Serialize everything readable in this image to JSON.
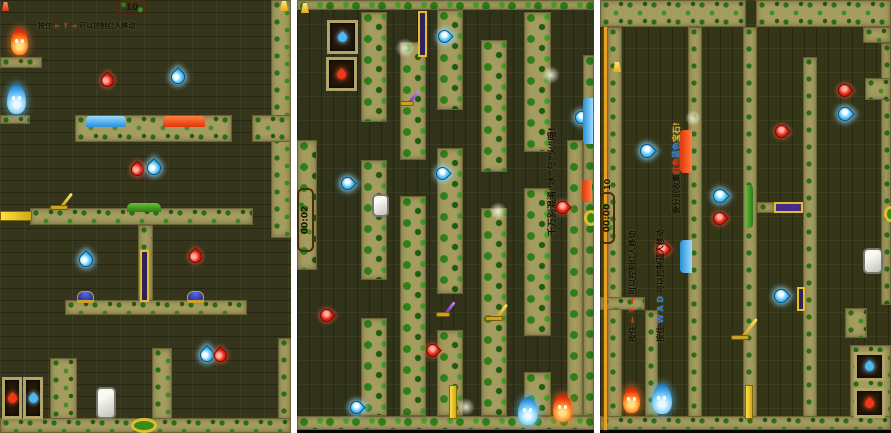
{
  "app": {
    "description": "Three level screenshots of a forest ice-and-fire two-player maze game",
    "background_color": "#ffffff"
  },
  "colors": {
    "wall_khaki": "#a59c60",
    "maze_dark": "#35351c",
    "leaf_green": "#2e8018",
    "gem_red": "#e82818",
    "gem_blue": "#58c8ff",
    "fireboy_red": "#e03010",
    "watergirl_blue": "#2888d0",
    "lever_gold": "#e0be2e",
    "lever_purple": "#6a2ab8",
    "sign_wood": "#8a5c2a",
    "text_dark": "#141005",
    "text_red": "#d83214",
    "text_blue": "#2f7fe0",
    "text_gold": "#e2b81c"
  },
  "panels": [
    {
      "id": "level-a-landscape",
      "mossy": false,
      "hud": {
        "sign": "10"
      },
      "walls": [
        [
          271,
          0,
          20,
          238
        ],
        [
          252,
          115,
          39,
          27
        ],
        [
          0,
          57,
          42,
          11
        ],
        [
          0,
          115,
          30,
          9
        ],
        [
          75,
          115,
          157,
          27
        ],
        [
          30,
          208,
          223,
          17
        ],
        [
          138,
          225,
          15,
          77
        ],
        [
          65,
          300,
          182,
          15
        ],
        [
          152,
          348,
          20,
          72
        ],
        [
          50,
          358,
          27,
          62
        ],
        [
          278,
          338,
          13,
          82
        ],
        [
          0,
          418,
          291,
          15
        ]
      ],
      "objects": [
        {
          "type": "lantern",
          "color": "red",
          "x": 2,
          "y": 2,
          "w": 7,
          "h": 9
        },
        {
          "type": "lantern",
          "color": "gold",
          "x": 280,
          "y": 1,
          "w": 8,
          "h": 10
        },
        {
          "type": "sign",
          "x": 116,
          "y": 0,
          "w": 32,
          "h": 15
        },
        {
          "type": "character",
          "who": "fireboy",
          "x": 11,
          "y": 28,
          "w": 17,
          "h": 27
        },
        {
          "type": "character",
          "who": "watergirl",
          "x": 7,
          "y": 84,
          "w": 19,
          "h": 30
        },
        {
          "type": "gem",
          "color": "red",
          "dir": "up",
          "x": 101,
          "y": 74,
          "w": 13,
          "h": 13
        },
        {
          "type": "gem",
          "color": "blue",
          "dir": "up",
          "x": 171,
          "y": 70,
          "w": 14,
          "h": 14
        },
        {
          "type": "pool",
          "kind": "water",
          "orient": "h",
          "x": 86,
          "y": 116,
          "w": 40,
          "h": 11
        },
        {
          "type": "pool",
          "kind": "lava",
          "orient": "h",
          "x": 163,
          "y": 116,
          "w": 42,
          "h": 11
        },
        {
          "type": "gem",
          "color": "red",
          "dir": "up",
          "x": 131,
          "y": 163,
          "w": 13,
          "h": 13
        },
        {
          "type": "gem",
          "color": "blue",
          "dir": "up",
          "x": 147,
          "y": 161,
          "w": 14,
          "h": 14
        },
        {
          "type": "yplat",
          "x": 0,
          "y": 211,
          "w": 32,
          "h": 10
        },
        {
          "type": "lever",
          "color": "gold",
          "x": 50,
          "y": 194,
          "w": 18,
          "h": 16
        },
        {
          "type": "pool",
          "kind": "grass",
          "orient": "h",
          "x": 127,
          "y": 203,
          "w": 34,
          "h": 9
        },
        {
          "type": "pole",
          "x": 140,
          "y": 250,
          "w": 9,
          "h": 52
        },
        {
          "type": "gem",
          "color": "blue",
          "dir": "up",
          "x": 79,
          "y": 253,
          "w": 14,
          "h": 14
        },
        {
          "type": "gem",
          "color": "red",
          "dir": "up",
          "x": 189,
          "y": 250,
          "w": 13,
          "h": 13
        },
        {
          "type": "pbutton",
          "x": 77,
          "y": 291,
          "w": 17,
          "h": 10
        },
        {
          "type": "pbutton",
          "x": 187,
          "y": 291,
          "w": 17,
          "h": 10
        },
        {
          "type": "gem",
          "color": "blue",
          "dir": "up",
          "x": 200,
          "y": 348,
          "w": 14,
          "h": 14
        },
        {
          "type": "gem",
          "color": "red",
          "dir": "up",
          "x": 214,
          "y": 349,
          "w": 13,
          "h": 13
        },
        {
          "type": "rock",
          "x": 96,
          "y": 387,
          "w": 20,
          "h": 32
        },
        {
          "type": "door",
          "kind": "fire",
          "x": 2,
          "y": 377,
          "w": 20,
          "h": 42
        },
        {
          "type": "door",
          "kind": "water",
          "x": 23,
          "y": 377,
          "w": 20,
          "h": 42
        },
        {
          "type": "ring",
          "x": 131,
          "y": 418,
          "w": 26,
          "h": 15
        }
      ],
      "instructions": [
        {
          "x": 38,
          "y": 21,
          "rotated": false,
          "size": 7,
          "segments": [
            {
              "text": "按住 ",
              "color": "#141005"
            },
            {
              "text": "← ↑ →",
              "color": "#d83214"
            },
            {
              "text": " 可以控制红人移动",
              "color": "#141005"
            }
          ]
        }
      ]
    },
    {
      "id": "level-b-portrait-rotated",
      "mossy": true,
      "hud": {
        "timer": "00:02"
      },
      "walls": [
        [
          0,
          0,
          297,
          10
        ],
        [
          286,
          55,
          11,
          361
        ],
        [
          0,
          140,
          20,
          130
        ],
        [
          64,
          12,
          26,
          110
        ],
        [
          64,
          160,
          26,
          120
        ],
        [
          64,
          318,
          26,
          98
        ],
        [
          103,
          42,
          26,
          118
        ],
        [
          103,
          196,
          26,
          220
        ],
        [
          140,
          10,
          26,
          100
        ],
        [
          140,
          148,
          26,
          146
        ],
        [
          140,
          330,
          26,
          86
        ],
        [
          184,
          40,
          26,
          132
        ],
        [
          184,
          208,
          26,
          208
        ],
        [
          227,
          12,
          27,
          140
        ],
        [
          227,
          188,
          27,
          148
        ],
        [
          227,
          372,
          27,
          44
        ],
        [
          270,
          140,
          16,
          276
        ],
        [
          0,
          416,
          297,
          14
        ]
      ],
      "objects": [
        {
          "type": "bar",
          "x": 0,
          "y": 430,
          "w": 297,
          "h": 3
        },
        {
          "type": "lantern",
          "color": "gold",
          "x": 4,
          "y": 3,
          "w": 8,
          "h": 10
        },
        {
          "type": "timersign",
          "x": 0,
          "y": 188,
          "w": 17,
          "h": 64
        },
        {
          "type": "door",
          "kind": "water",
          "x": 30,
          "y": 20,
          "w": 31,
          "h": 34
        },
        {
          "type": "door",
          "kind": "fire",
          "x": 29,
          "y": 57,
          "w": 31,
          "h": 34
        },
        {
          "type": "pole",
          "x": 121,
          "y": 11,
          "w": 9,
          "h": 46
        },
        {
          "type": "lever",
          "color": "purple",
          "x": 103,
          "y": 92,
          "w": 14,
          "h": 14
        },
        {
          "type": "glow",
          "x": 98,
          "y": 38,
          "w": 20,
          "h": 20
        },
        {
          "type": "glow",
          "x": 245,
          "y": 66,
          "w": 18,
          "h": 18
        },
        {
          "type": "glow",
          "x": 192,
          "y": 202,
          "w": 18,
          "h": 18
        },
        {
          "type": "glow",
          "x": 160,
          "y": 398,
          "w": 18,
          "h": 18
        },
        {
          "type": "gem",
          "color": "blue",
          "dir": "right",
          "x": 141,
          "y": 30,
          "w": 13,
          "h": 13
        },
        {
          "type": "gem",
          "color": "blue",
          "dir": "right",
          "x": 44,
          "y": 177,
          "w": 13,
          "h": 13
        },
        {
          "type": "gem",
          "color": "blue",
          "dir": "right",
          "x": 139,
          "y": 167,
          "w": 13,
          "h": 13
        },
        {
          "type": "gem",
          "color": "blue",
          "dir": "right",
          "x": 278,
          "y": 111,
          "w": 13,
          "h": 13
        },
        {
          "type": "gem",
          "color": "blue",
          "dir": "right",
          "x": 53,
          "y": 401,
          "w": 13,
          "h": 13
        },
        {
          "type": "gem",
          "color": "red",
          "dir": "right",
          "x": 23,
          "y": 309,
          "w": 13,
          "h": 13
        },
        {
          "type": "gem",
          "color": "red",
          "dir": "right",
          "x": 129,
          "y": 344,
          "w": 13,
          "h": 13
        },
        {
          "type": "gem",
          "color": "red",
          "dir": "right",
          "x": 259,
          "y": 201,
          "w": 13,
          "h": 13
        },
        {
          "type": "rock",
          "x": 75,
          "y": 194,
          "w": 17,
          "h": 23
        },
        {
          "type": "lever",
          "color": "purple",
          "x": 139,
          "y": 303,
          "w": 14,
          "h": 14
        },
        {
          "type": "lever",
          "color": "gold",
          "x": 188,
          "y": 305,
          "w": 18,
          "h": 16
        },
        {
          "type": "yplat",
          "x": 152,
          "y": 385,
          "w": 8,
          "h": 34
        },
        {
          "type": "character",
          "who": "watergirl",
          "x": 221,
          "y": 397,
          "w": 20,
          "h": 28
        },
        {
          "type": "character",
          "who": "fireboy",
          "x": 256,
          "y": 394,
          "w": 19,
          "h": 28
        },
        {
          "type": "pool",
          "kind": "water",
          "orient": "v",
          "x": 286,
          "y": 98,
          "w": 10,
          "h": 46
        },
        {
          "type": "pool",
          "kind": "lava",
          "orient": "v",
          "x": 285,
          "y": 180,
          "w": 10,
          "h": 22
        },
        {
          "type": "ring",
          "x": 287,
          "y": 210,
          "w": 14,
          "h": 16
        }
      ],
      "instructions": [
        {
          "x": 248,
          "y": 236,
          "rotated": true,
          "size": 9,
          "segments": [
            {
              "text": "千万别混淆“冰”与“火”哦!",
              "color": "#141005"
            }
          ]
        }
      ]
    },
    {
      "id": "level-c-portrait-rotated",
      "mossy": false,
      "hud": {
        "timer": "00:00",
        "score": "10"
      },
      "walls": [
        [
          0,
          0,
          146,
          27
        ],
        [
          156,
          0,
          135,
          27
        ],
        [
          263,
          27,
          28,
          16
        ],
        [
          281,
          43,
          10,
          262
        ],
        [
          7,
          27,
          15,
          391
        ],
        [
          88,
          27,
          14,
          391
        ],
        [
          143,
          27,
          14,
          391
        ],
        [
          203,
          57,
          14,
          361
        ],
        [
          45,
          310,
          13,
          106
        ],
        [
          0,
          297,
          45,
          13
        ],
        [
          245,
          308,
          22,
          30
        ],
        [
          265,
          78,
          26,
          22
        ],
        [
          250,
          345,
          41,
          73
        ],
        [
          0,
          416,
          291,
          14
        ],
        [
          157,
          202,
          18,
          11
        ]
      ],
      "objects": [
        {
          "type": "bar",
          "x": 0,
          "y": 430,
          "w": 291,
          "h": 3
        },
        {
          "type": "accent",
          "x": 4,
          "y": 27,
          "w": 3,
          "h": 403
        },
        {
          "type": "lantern",
          "color": "gold",
          "x": 13,
          "y": 62,
          "w": 8,
          "h": 10
        },
        {
          "type": "timersign",
          "x": 0,
          "y": 192,
          "w": 15,
          "h": 52
        },
        {
          "type": "vlabel",
          "x": 3,
          "y": 190,
          "w": 10,
          "h": 12
        },
        {
          "type": "gem",
          "color": "red",
          "dir": "right",
          "x": 238,
          "y": 84,
          "w": 13,
          "h": 13
        },
        {
          "type": "gem",
          "color": "blue",
          "dir": "right",
          "x": 238,
          "y": 107,
          "w": 14,
          "h": 14
        },
        {
          "type": "gem",
          "color": "red",
          "dir": "right",
          "x": 175,
          "y": 125,
          "w": 13,
          "h": 13
        },
        {
          "type": "gem",
          "color": "blue",
          "dir": "right",
          "x": 40,
          "y": 144,
          "w": 14,
          "h": 14
        },
        {
          "type": "gem",
          "color": "red",
          "dir": "right",
          "x": 56,
          "y": 243,
          "w": 13,
          "h": 13
        },
        {
          "type": "gem",
          "color": "blue",
          "dir": "right",
          "x": 113,
          "y": 189,
          "w": 14,
          "h": 14
        },
        {
          "type": "gem",
          "color": "red",
          "dir": "right",
          "x": 113,
          "y": 212,
          "w": 13,
          "h": 13
        },
        {
          "type": "gem",
          "color": "blue",
          "dir": "right",
          "x": 174,
          "y": 289,
          "w": 14,
          "h": 14
        },
        {
          "type": "pole",
          "x": 197,
          "y": 287,
          "w": 8,
          "h": 24
        },
        {
          "type": "pool",
          "kind": "lava",
          "orient": "v",
          "x": 80,
          "y": 130,
          "w": 12,
          "h": 43
        },
        {
          "type": "pool",
          "kind": "water",
          "orient": "v",
          "x": 80,
          "y": 240,
          "w": 12,
          "h": 33
        },
        {
          "type": "pool",
          "kind": "grass",
          "orient": "v",
          "x": 145,
          "y": 185,
          "w": 8,
          "h": 43
        },
        {
          "type": "pplat",
          "x": 174,
          "y": 202,
          "w": 29,
          "h": 11
        },
        {
          "type": "rock",
          "x": 263,
          "y": 248,
          "w": 20,
          "h": 26
        },
        {
          "type": "ring",
          "x": 284,
          "y": 206,
          "w": 12,
          "h": 16
        },
        {
          "type": "lever",
          "color": "gold",
          "x": 131,
          "y": 318,
          "w": 18,
          "h": 22
        },
        {
          "type": "yplat",
          "x": 145,
          "y": 385,
          "w": 8,
          "h": 34
        },
        {
          "type": "character",
          "who": "fireboy",
          "x": 23,
          "y": 387,
          "w": 17,
          "h": 26
        },
        {
          "type": "character",
          "who": "watergirl",
          "x": 52,
          "y": 384,
          "w": 20,
          "h": 30
        },
        {
          "type": "door",
          "kind": "water",
          "x": 254,
          "y": 352,
          "w": 31,
          "h": 29
        },
        {
          "type": "door",
          "kind": "fire",
          "x": 254,
          "y": 388,
          "w": 31,
          "h": 30
        },
        {
          "type": "glow",
          "x": 85,
          "y": 110,
          "w": 16,
          "h": 16
        }
      ],
      "instructions": [
        {
          "x": 27,
          "y": 342,
          "rotated": true,
          "size": 8,
          "segments": [
            {
              "text": "按住 ",
              "color": "#141005"
            },
            {
              "text": "← ↑ →",
              "color": "#d83214"
            },
            {
              "text": " 可以控制红人移动",
              "color": "#141005"
            }
          ]
        },
        {
          "x": 55,
          "y": 342,
          "rotated": true,
          "size": 8,
          "segments": [
            {
              "text": "按住 ",
              "color": "#141005"
            },
            {
              "text": "W A D",
              "color": "#2f7fe0"
            },
            {
              "text": " 可以控制蓝人移动",
              "color": "#141005"
            }
          ]
        },
        {
          "x": 71,
          "y": 214,
          "rotated": true,
          "size": 8,
          "segments": [
            {
              "text": "要分别收集",
              "color": "#141005"
            },
            {
              "text": "红色",
              "color": "#d83214"
            },
            {
              "text": "蓝色",
              "color": "#2f7fe0"
            },
            {
              "text": "宝石!",
              "color": "#e2b81c"
            }
          ]
        }
      ]
    }
  ]
}
